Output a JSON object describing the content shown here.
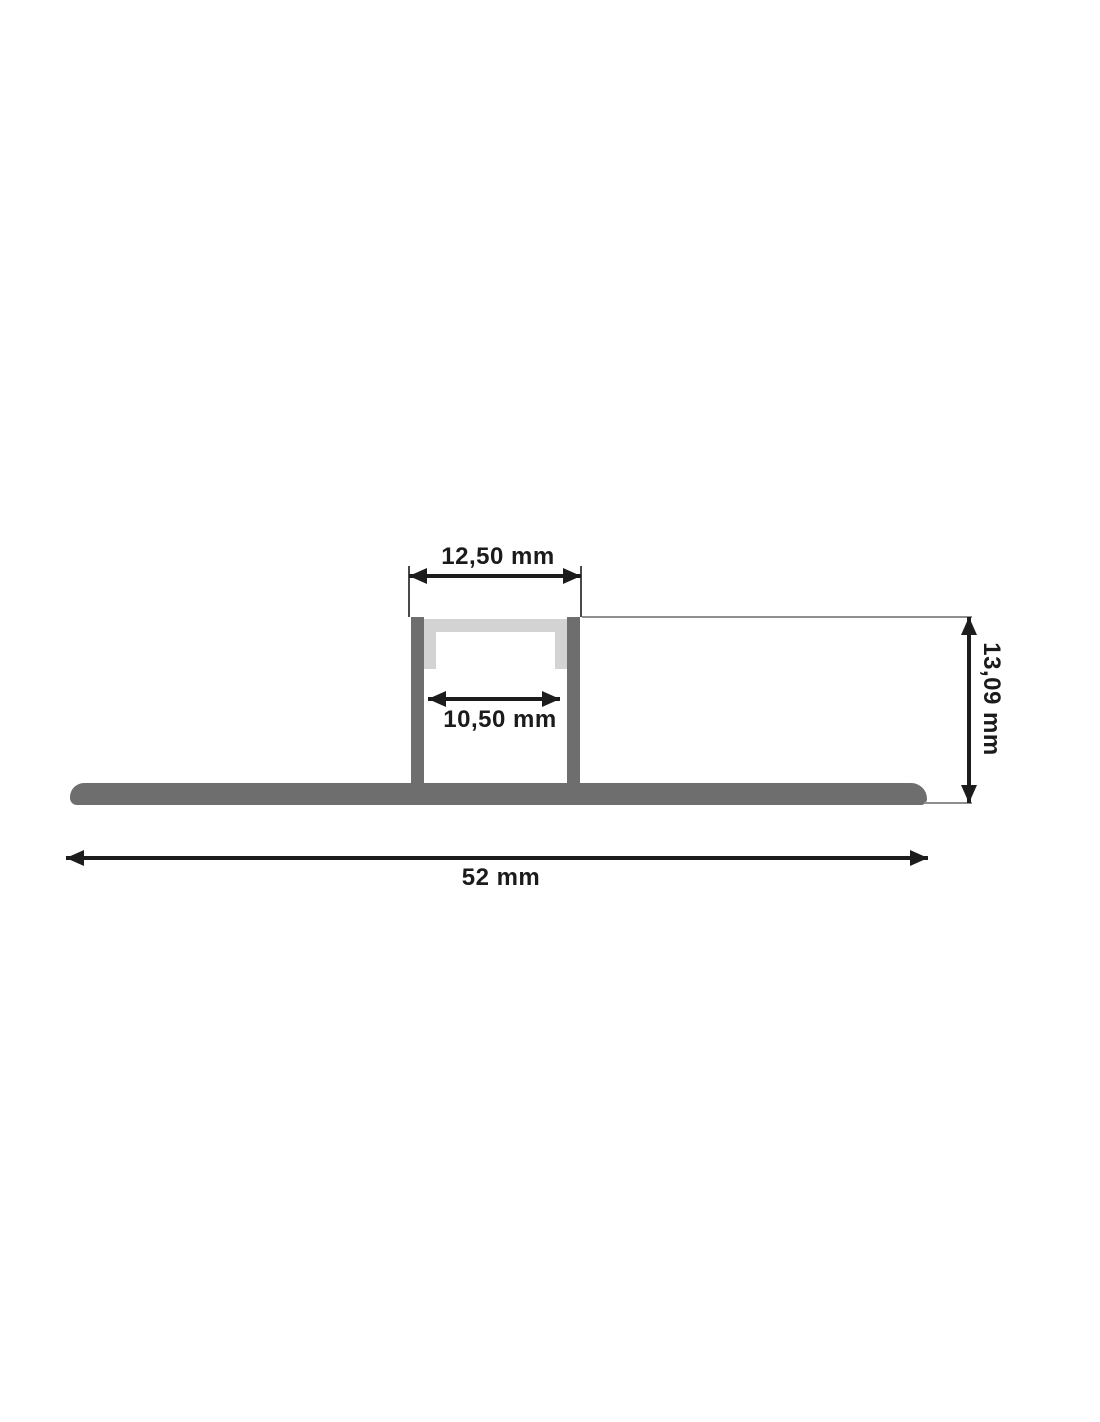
{
  "drawing": {
    "title": "LED profile cross-section technical drawing",
    "dimensions": {
      "outer_width": {
        "label": "12,50 mm",
        "value_mm": 12.5,
        "description": "outer width of channel"
      },
      "inner_width": {
        "label": "10,50 mm",
        "value_mm": 10.5,
        "description": "inner width of channel"
      },
      "height": {
        "label": "13,09 mm",
        "value_mm": 13.09,
        "description": "overall height, label rotated 90 degrees"
      },
      "total_width": {
        "label": "52 mm",
        "value_mm": 52,
        "description": "total width of base flange"
      }
    },
    "parts": {
      "base_flange": "wide flat mounting flange with rounded ends",
      "left_wall": "vertical channel wall",
      "right_wall": "vertical channel wall",
      "diffuser_cover": "light gray cover lid with two clip legs"
    },
    "colors": {
      "profile_gray": "#6e6e6e",
      "diffuser_gray": "#d3d3d3",
      "dimension_black": "#1c1c1c",
      "extension_line_gray": "#8f8f8f",
      "background": "#ffffff"
    }
  }
}
